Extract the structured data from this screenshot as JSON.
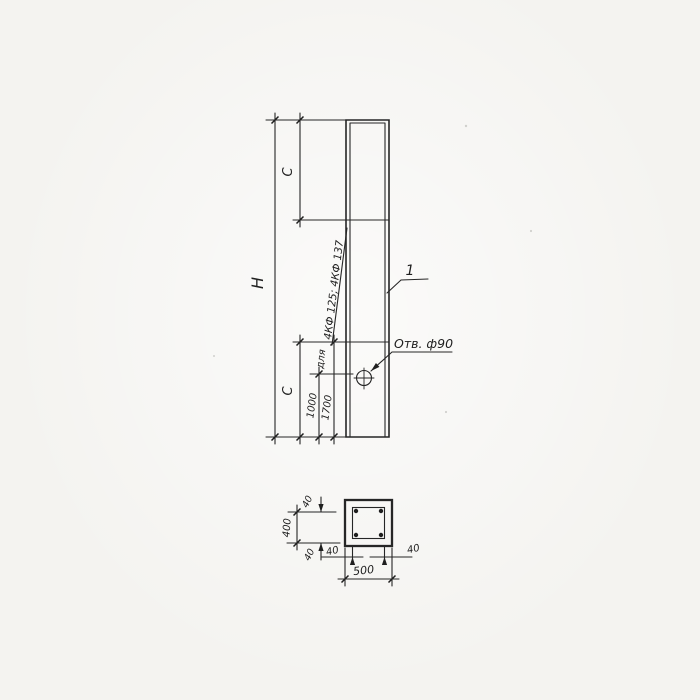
{
  "page": {
    "paper_color": "#f4f3f0",
    "ink_color": "#262626"
  },
  "elevation": {
    "height_label": "H",
    "c_top_label": "C",
    "c_bottom_label": "C",
    "hole_offset_label": "1000",
    "c_value_label": "1700",
    "note_prefix": "для",
    "note_models": "4КФ 125; 4КФ 137",
    "hole_callout": "Отв. ф90",
    "part_number": "1"
  },
  "section": {
    "overall_width": "500",
    "overall_height": "400",
    "cover_top": "40",
    "cover_bottom": "40",
    "cover_left": "40",
    "cover_right": "40"
  }
}
